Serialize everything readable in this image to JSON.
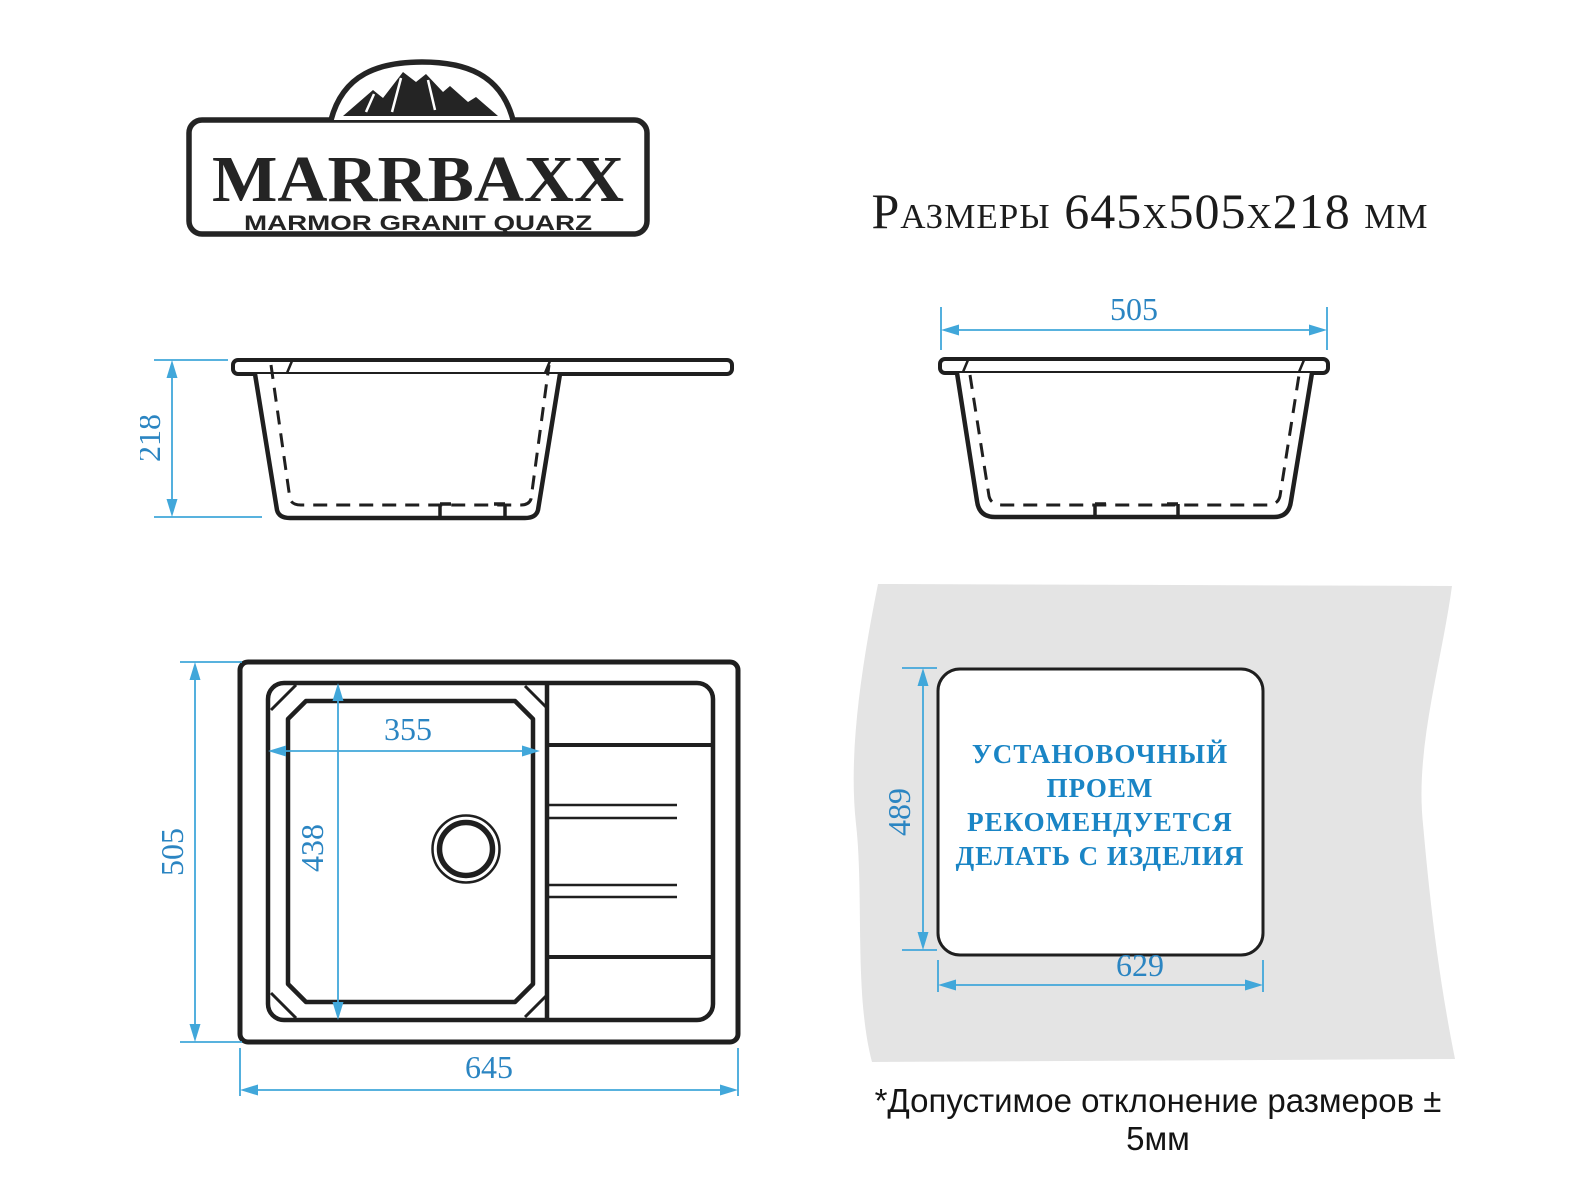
{
  "colors": {
    "drawing_line": "#1f1f1f",
    "dimension_line": "#41a7da",
    "dimension_text": "#2b85c2",
    "install_text": "#1a85c5",
    "panel_gray": "#e4e4e4"
  },
  "logo": {
    "brand": "MARRBAXX",
    "tagline": "MARMOR GRANIT QUARZ"
  },
  "title": {
    "label": "Размеры",
    "dimensions": "645х505х218",
    "unit": "мм"
  },
  "drawings": {
    "front_section": {
      "height": "218"
    },
    "side_section": {
      "width": "505"
    },
    "top_view": {
      "bowl_width": "355",
      "bowl_depth": "438",
      "depth": "505",
      "width": "645"
    },
    "installation": {
      "height": "489",
      "width": "629",
      "note_lines": [
        "УСТАНОВОЧНЫЙ",
        "ПРОЕМ",
        "РЕКОМЕНДУЕТСЯ",
        "ДЕЛАТЬ С ИЗДЕЛИЯ"
      ]
    }
  },
  "footnote": "*Допустимое отклонение размеров ± 5мм"
}
